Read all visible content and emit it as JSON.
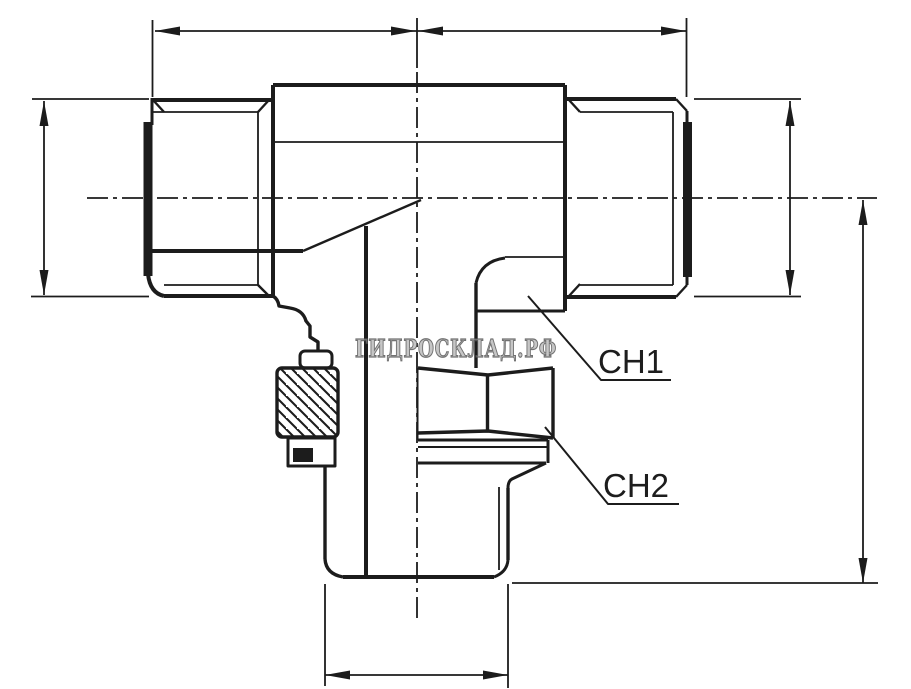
{
  "drawing": {
    "title": "tee-adapter-technical-drawing",
    "callouts": {
      "ch1": "CH1",
      "ch2": "CH2"
    },
    "watermark": {
      "text": "ГИДРОСКЛАД.РФ"
    },
    "colors": {
      "ink": "#1c1c1c",
      "background": "#ffffff",
      "callout_text": "#1d1d1d",
      "watermark_fill": "#bdbdbd",
      "watermark_stroke": "#5a5a5a"
    }
  }
}
